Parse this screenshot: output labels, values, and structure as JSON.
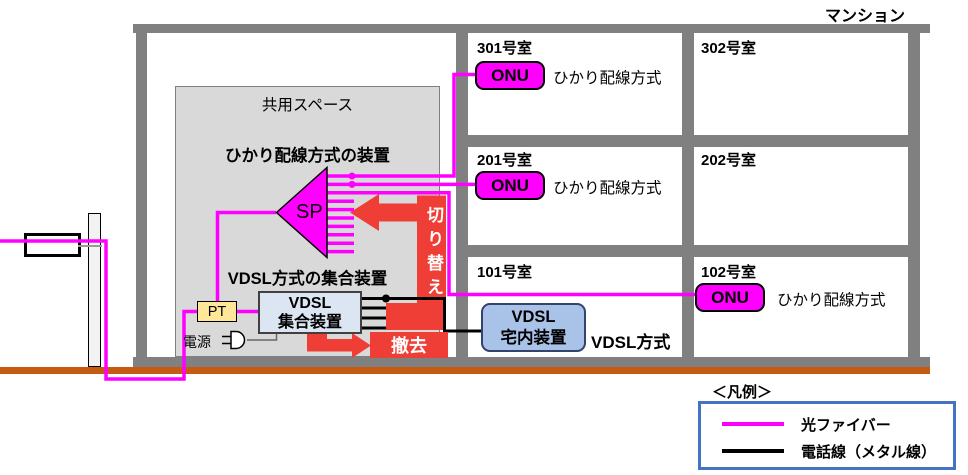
{
  "building_title": "マンション",
  "building": {
    "rooms": [
      {
        "label": "301号室",
        "device": "ONU",
        "method": "ひかり配線方式"
      },
      {
        "label": "302号室"
      },
      {
        "label": "201号室",
        "device": "ONU",
        "method": "ひかり配線方式"
      },
      {
        "label": "202号室"
      },
      {
        "label": "101号室",
        "device_line1": "VDSL",
        "device_line2": "宅内装置",
        "method": "VDSL方式"
      },
      {
        "label": "102号室",
        "device": "ONU",
        "method": "ひかり配線方式"
      }
    ]
  },
  "shared": {
    "label": "共用スペース",
    "optical_section": "ひかり配線方式の装置",
    "splitter": "SP",
    "vdsl_section": "VDSL方式の集合装置",
    "vdsl_agg_line1": "VDSL",
    "vdsl_agg_line2": "集合装置",
    "pt": "PT",
    "power": "電源"
  },
  "actions": {
    "switch": "切り替え",
    "remove": "撤去"
  },
  "legend": {
    "title": "＜凡例＞",
    "items": [
      {
        "label": "光ファイバー",
        "color": "#ff00ff"
      },
      {
        "label": "電話線（メタル線）",
        "color": "#000000"
      }
    ]
  },
  "colors": {
    "fiber": "#ff00ff",
    "metal_line": "#000000",
    "arrow_red": "#ee3e36",
    "ground": "#c55a11",
    "legend_border": "#4472c4",
    "wall_gray": "#808080",
    "shared_space_fill": "#d9d9d9",
    "pt_fill": "#ffe699",
    "vdsl_home_fill": "#a8c2e8",
    "vdsl_agg_fill": "#dce6f2"
  }
}
